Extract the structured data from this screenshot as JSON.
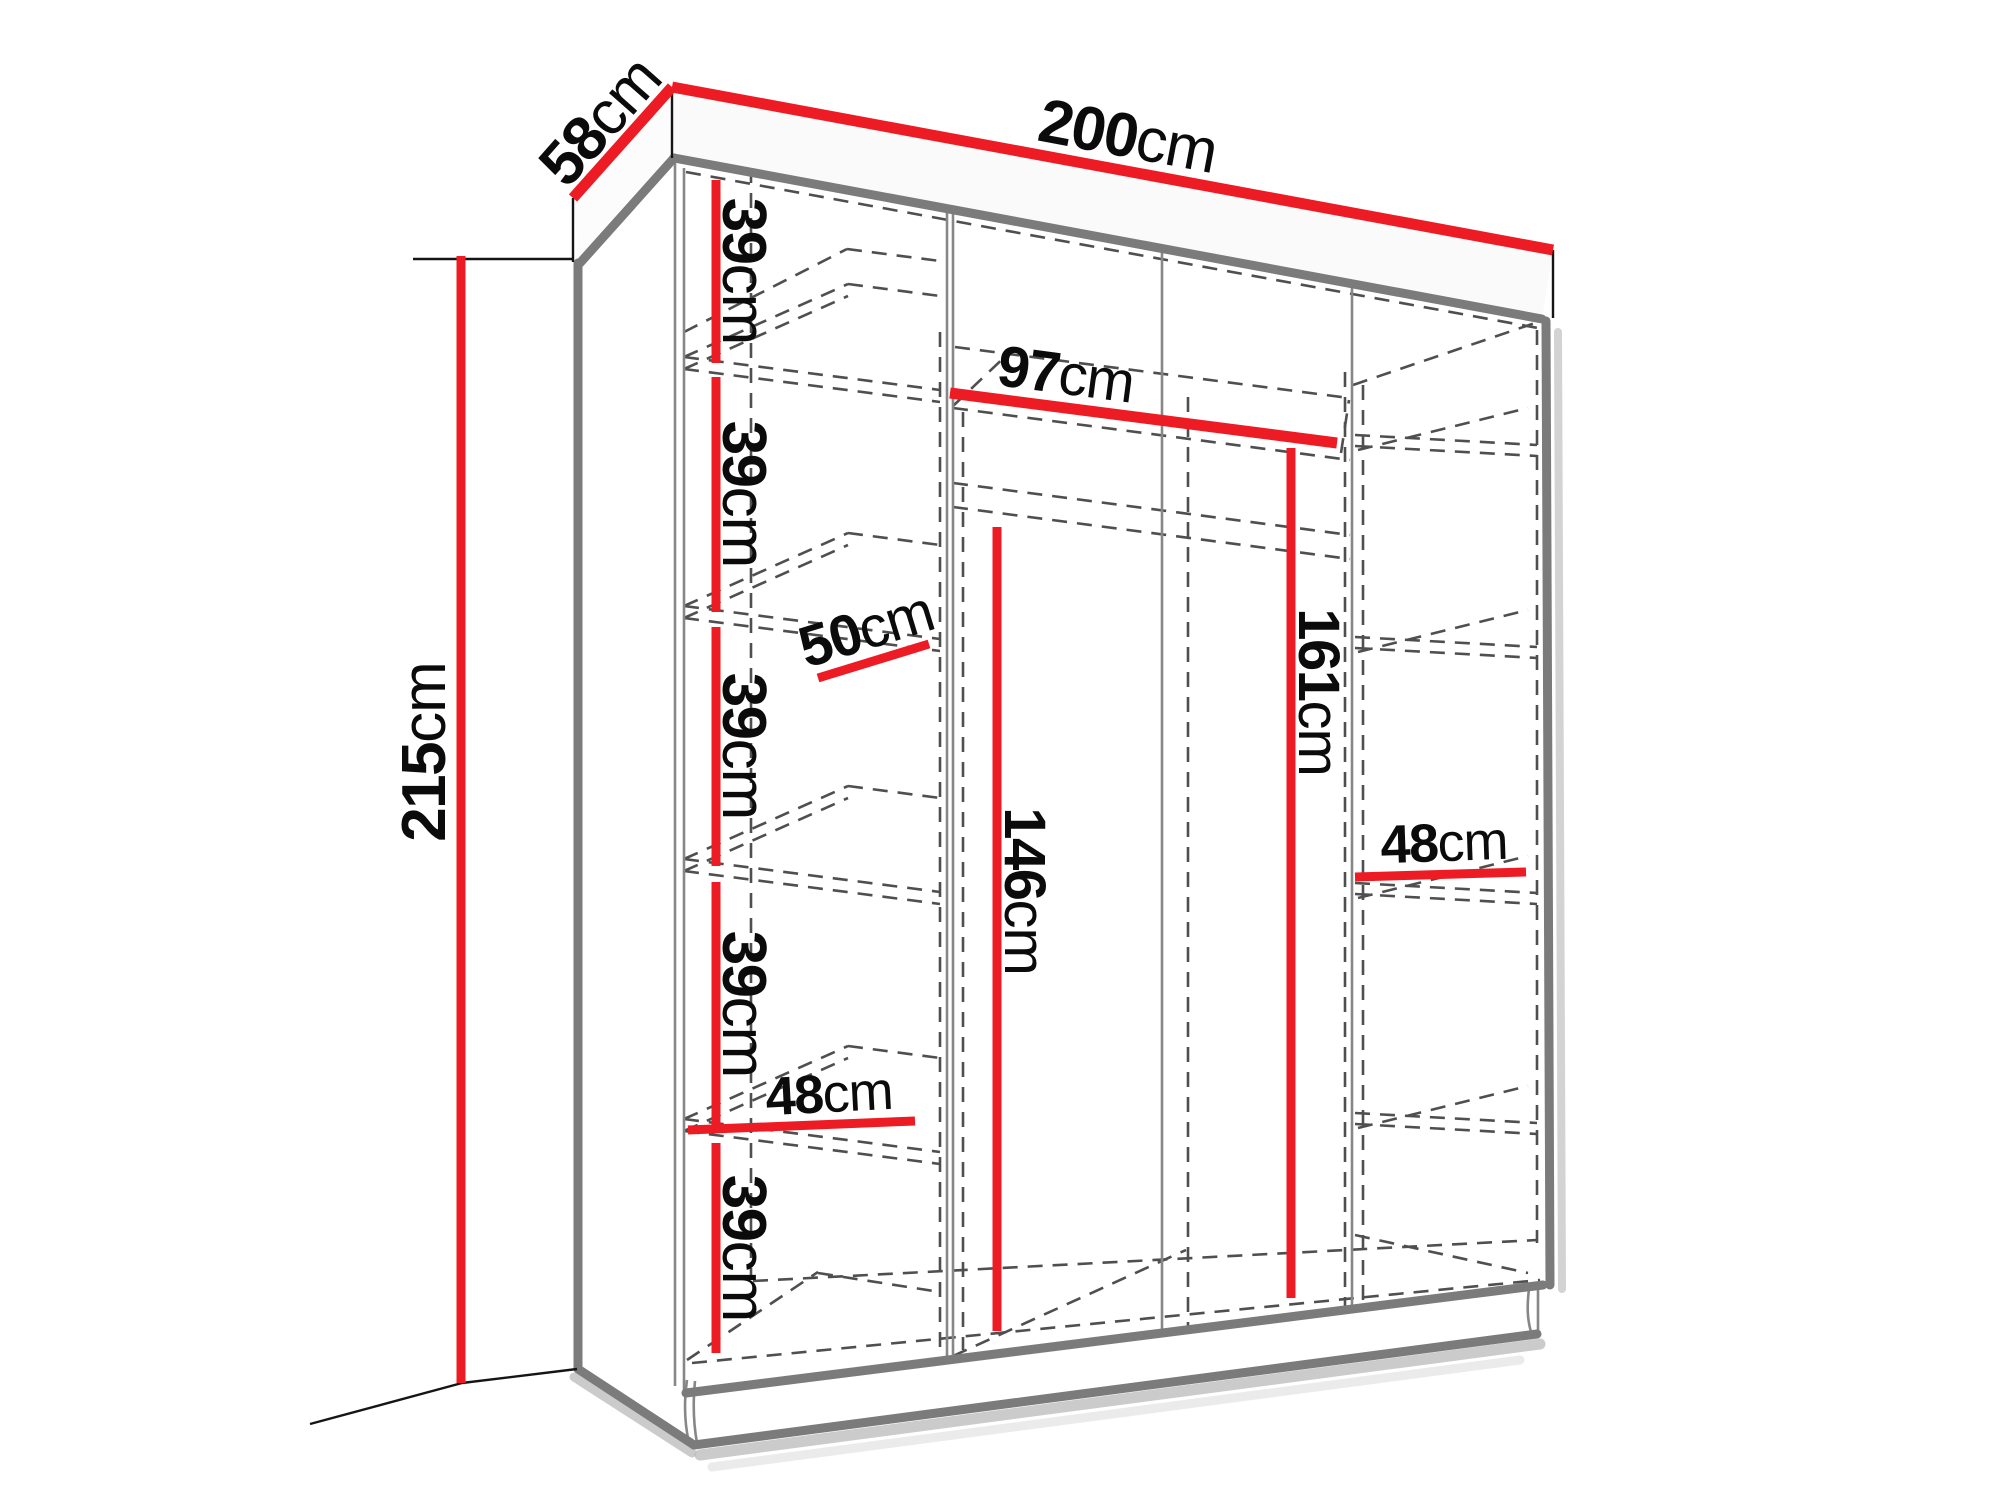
{
  "diagram": {
    "kind": "wardrobe dimension diagram",
    "projection": "perspective line drawing with dashed hidden edges",
    "unit": "cm",
    "colors": {
      "dimension": "#ED1C24",
      "outline": "#7B7B7B",
      "hidden": "#4F4F4F",
      "extension": "#151515",
      "text": "#0B0B0B"
    },
    "overall": {
      "width": {
        "num": "200",
        "unit": "cm"
      },
      "depth": {
        "num": "58",
        "unit": "cm"
      },
      "height": {
        "num": "215",
        "unit": "cm"
      }
    },
    "interior": {
      "middle_section_width": {
        "num": "97",
        "unit": "cm"
      },
      "shelf_depth": {
        "num": "50",
        "unit": "cm"
      },
      "height_under_rod": {
        "num": "146",
        "unit": "cm"
      },
      "height_under_top_shelf": {
        "num": "161",
        "unit": "cm"
      },
      "left_column_width": {
        "num": "48",
        "unit": "cm"
      },
      "right_column_width": {
        "num": "48",
        "unit": "cm"
      },
      "shelf_gaps": [
        {
          "num": "39",
          "unit": "cm"
        },
        {
          "num": "39",
          "unit": "cm"
        },
        {
          "num": "39",
          "unit": "cm"
        },
        {
          "num": "39",
          "unit": "cm"
        },
        {
          "num": "39",
          "unit": "cm"
        }
      ]
    }
  }
}
